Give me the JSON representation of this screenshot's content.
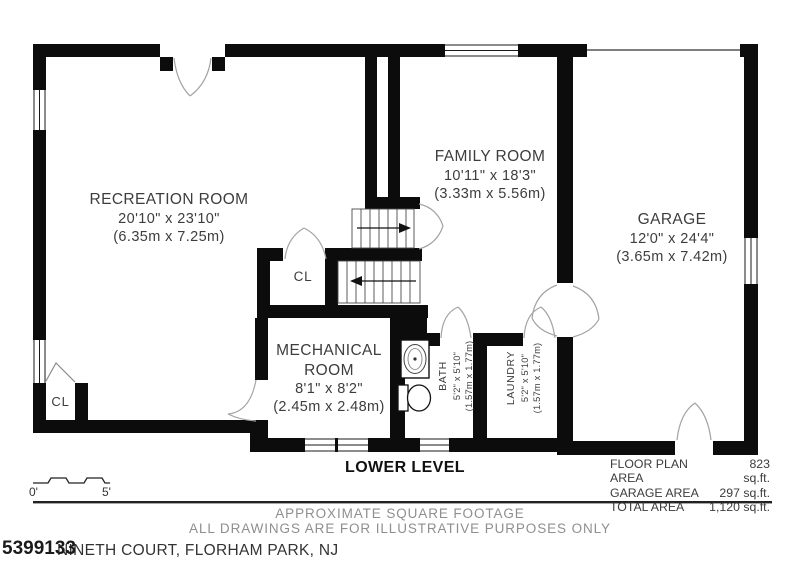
{
  "plan": {
    "title": "LOWER LEVEL",
    "rooms": {
      "recreation": {
        "name": "RECREATION ROOM",
        "dims": "20'10\" x 23'10\"",
        "metric": "(6.35m x 7.25m)"
      },
      "family": {
        "name": "FAMILY ROOM",
        "dims": "10'11\" x 18'3\"",
        "metric": "(3.33m x 5.56m)"
      },
      "garage": {
        "name": "GARAGE",
        "dims": "12'0\" x 24'4\"",
        "metric": "(3.65m x 7.42m)"
      },
      "mechanical": {
        "name": "MECHANICAL ROOM",
        "dims": "8'1\" x 8'2\"",
        "metric": "(2.45m x 2.48m)"
      },
      "bath": {
        "name": "BATH",
        "dims": "5'2\" x 5'10\"",
        "metric": "(1.57m x 1.77m)"
      },
      "laundry": {
        "name": "LAUNDRY",
        "dims": "5'2\" x 5'10\"",
        "metric": "(1.57m x 1.77m)"
      },
      "closet_mid": {
        "name": "CL"
      },
      "closet_left": {
        "name": "CL"
      }
    },
    "scale": {
      "start": "0'",
      "end": "5'"
    },
    "areas": {
      "rows": [
        {
          "label": "FLOOR PLAN AREA",
          "value": "823 sq.ft."
        },
        {
          "label": "GARAGE AREA",
          "value": "297 sq.ft."
        },
        {
          "label": "TOTAL AREA",
          "value": "1,120 sq.ft."
        }
      ]
    },
    "disclaimer": {
      "line1": "APPROXIMATE SQUARE FOOTAGE",
      "line2": "ALL DRAWINGS ARE FOR ILLUSTRATIVE PURPOSES ONLY"
    },
    "footer": {
      "watermark": "5399133",
      "address": "NINETH COURT, FLORHAM PARK, NJ"
    }
  },
  "colors": {
    "wall": "#0c0c0c",
    "text": "#3d3d3d",
    "gray_text": "#8f8f8f",
    "door_arc": "#a3a3a3"
  }
}
